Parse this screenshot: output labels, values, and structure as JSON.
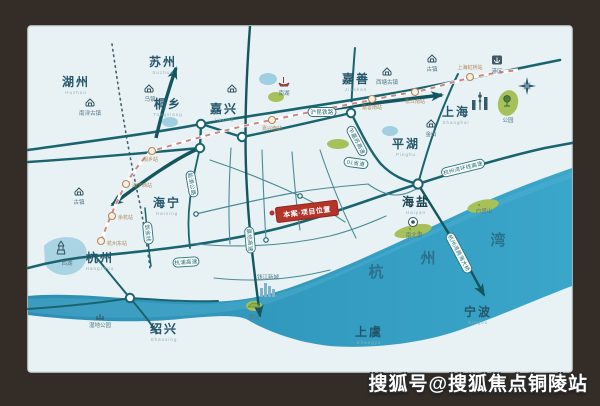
{
  "frame": {
    "caption": "区位示意图·规划信息仅供参考 车程约30min/30.5km 误差±0.5km",
    "watermark": "搜狐号@搜狐焦点铜陵站"
  },
  "colors": {
    "bay_blue": "#2f93b8",
    "road_teal": "#1a646f",
    "rail_pink": "#cc8484",
    "project_red": "#b5342a",
    "frame_brown": "#342c27"
  },
  "map": {
    "cities": [
      {
        "name": "湖州",
        "pinyin": "Huzhou"
      },
      {
        "name": "苏州",
        "pinyin": "Suzhou"
      },
      {
        "name": "桐乡",
        "pinyin": "Tongxiang"
      },
      {
        "name": "嘉兴",
        "pinyin": "Jiaxing"
      },
      {
        "name": "嘉善",
        "pinyin": "Jiashan"
      },
      {
        "name": "上海",
        "pinyin": "Shanghai"
      },
      {
        "name": "平湖",
        "pinyin": "Pinghu"
      },
      {
        "name": "海宁",
        "pinyin": "Haining"
      },
      {
        "name": "海盐",
        "pinyin": "Haiyan"
      },
      {
        "name": "杭州",
        "pinyin": "Hangzhou"
      },
      {
        "name": "绍兴",
        "pinyin": "Shaoxing"
      },
      {
        "name": "上虞",
        "pinyin": "Shangyu"
      },
      {
        "name": "宁波",
        "pinyin": "Ningbo"
      }
    ],
    "bay": {
      "c1": "杭",
      "c2": "州",
      "c3": "湾"
    },
    "project": {
      "label": "本案·项目位置"
    },
    "road_labels": {
      "hukun_rail": "沪昆铁路",
      "zjs_expwy": "乍嘉苏高速",
      "s01": "01省道",
      "g92": "杭州湾环线高速",
      "bridge": "杭州湾跨海大桥",
      "wengjin": "翁金线",
      "yanhu": "盐湖公路",
      "jiashao": "嘉绍高速",
      "hangpu": "杭浦高速"
    },
    "stations": [
      "杭州东站",
      "余杭站",
      "海宁西站",
      "桐乡站",
      "嘉兴南站",
      "嘉善南站",
      "松江南站",
      "上海虹桥站"
    ],
    "landmarks": {
      "west_lake": "西湖",
      "nanxun": "南浔古镇",
      "wuzhen": "乌镇",
      "town_w": "古镇",
      "nanhu": "南湖",
      "xitang": "西塘古镇",
      "town_ne": "古镇",
      "jinshan": "金山",
      "park": "公园",
      "port": "港区",
      "nanbeihu": "南北湖",
      "baitashan": "白塔山",
      "qianjiang": "钱江新城",
      "scenic": "景区",
      "wetland": "湿地公园"
    }
  }
}
